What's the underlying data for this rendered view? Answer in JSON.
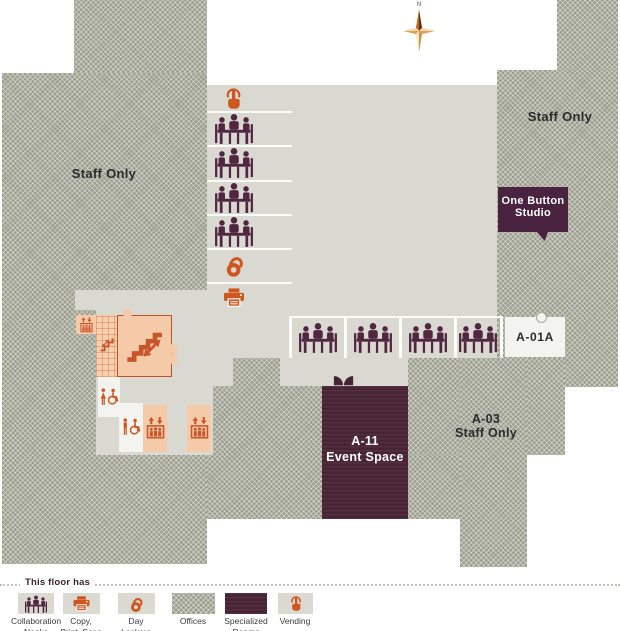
{
  "map": {
    "compass": {
      "label": "N"
    },
    "labels": {
      "staff_left": "Staff Only",
      "staff_right": "Staff Only",
      "one_button_studio": [
        "One Button",
        "Studio"
      ],
      "a01a": "A-01A",
      "event_space": [
        "A-11",
        "Event Space"
      ],
      "a03": [
        "A-03",
        "Staff Only"
      ]
    },
    "amenity_icons": [
      "vending-touch",
      "collaboration-nook",
      "day-locker",
      "copy-print-scan",
      "stairs",
      "elevator",
      "accessible-restroom-women",
      "accessible-restroom-men",
      "double-door"
    ]
  },
  "legend": {
    "title": "This floor has",
    "items": [
      {
        "id": "collaboration-nooks",
        "label": [
          "Collaboration",
          "Nooks"
        ]
      },
      {
        "id": "copy-print-scan",
        "label": [
          "Copy,",
          "Print, Scan"
        ]
      },
      {
        "id": "day-lockers",
        "label": [
          "Day",
          "Lockers"
        ]
      },
      {
        "id": "offices",
        "label": [
          "Offices",
          ""
        ]
      },
      {
        "id": "specialized-rooms",
        "label": [
          "Specialized",
          "Rooms"
        ]
      },
      {
        "id": "vending",
        "label": [
          "Vending",
          ""
        ]
      }
    ]
  },
  "colors": {
    "floor": "#d9d9d2",
    "offices_hatch_base": "#9d9f8e",
    "specialized_room": "#482334",
    "one_button_studio": "#4a2340",
    "accent_orange": "#d0561f",
    "nook_purple": "#512641",
    "stairs_peach": "#f4caa8",
    "room_white": "#f3f3ef"
  }
}
